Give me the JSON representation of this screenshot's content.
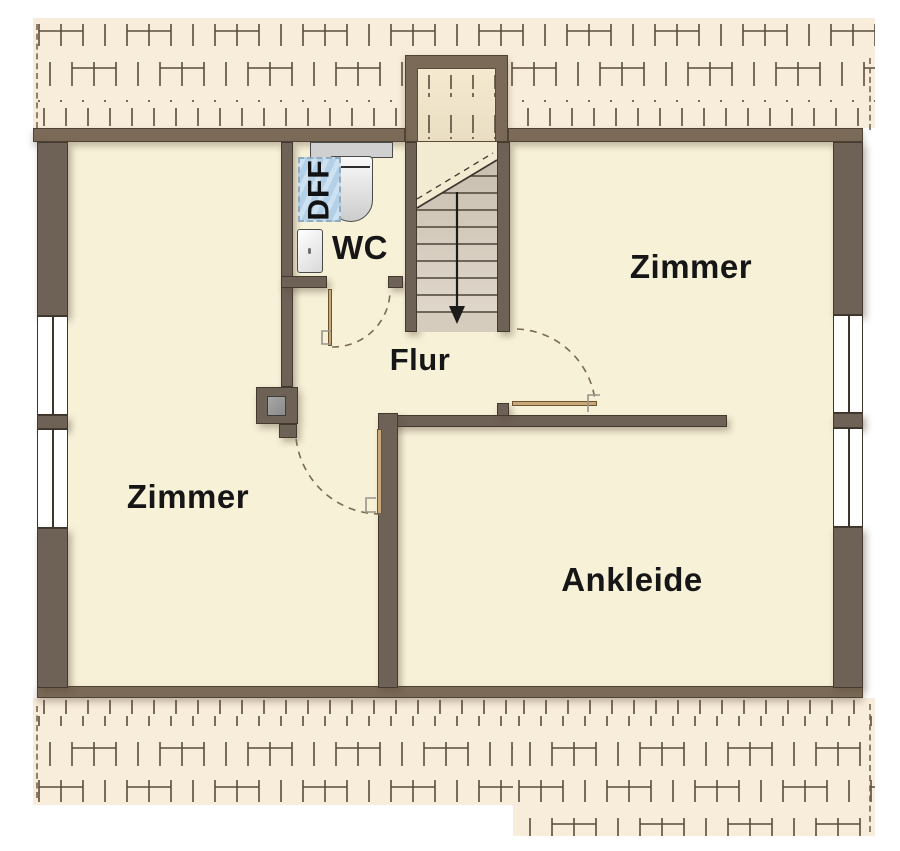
{
  "rooms": {
    "zimmer_left": {
      "label": "Zimmer"
    },
    "zimmer_right": {
      "label": "Zimmer"
    },
    "wc": {
      "label": "WC"
    },
    "flur": {
      "label": "Flur"
    },
    "ankleide": {
      "label": "Ankleide"
    }
  },
  "annotations": {
    "roof_window": {
      "label": "DFF"
    }
  },
  "colors": {
    "wall": "#6e6156",
    "wall_band": "#7b6a58",
    "floor": "#f7f1d8",
    "roof": "#f8ecda",
    "hatch": "#5b4b3b",
    "door": "#c9a87a",
    "dff_fill": "#b3d0e6",
    "arc": "#7b6a52"
  }
}
